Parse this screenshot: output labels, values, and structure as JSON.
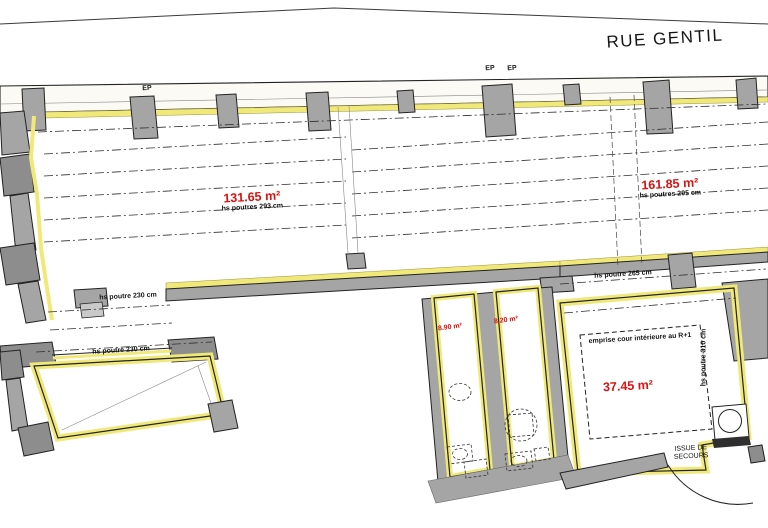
{
  "plan": {
    "street_name": "RUE GENTIL",
    "downspout_label": "EP",
    "emergency_exit_label": "ISSUE DE SECOURS",
    "rooms": [
      {
        "area": "131.65 m²",
        "beam_height": "hs poutres 293 cm"
      },
      {
        "area": "161.85 m²",
        "beam_height": "hs poutres 295 cm"
      },
      {
        "area": "8.90 m²"
      },
      {
        "area": "8.20 m²"
      },
      {
        "area": "37.45 m²",
        "beam_height": "hs poutre 310 cm",
        "courtyard_note": "emprise cour intérieure au R+1"
      }
    ],
    "beam_labels": [
      {
        "text": "hs poutre 230 cm"
      },
      {
        "text": "hs poutre 230 cm"
      },
      {
        "text": "hs poutre 265 cm"
      }
    ]
  },
  "colors": {
    "highlight_yellow": "#f0e97a",
    "wall_gray": "#a5a5a5",
    "dark_gray": "#8d8d8d",
    "area_red": "#d61212",
    "line_black": "#222222"
  }
}
